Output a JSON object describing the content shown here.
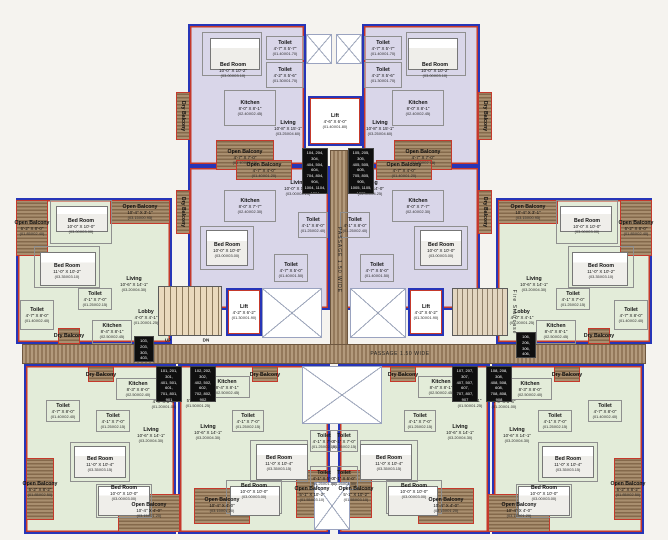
{
  "palette": {
    "unit_purple": "#d9d6e9",
    "unit_green": "#e3ecd9",
    "balcony_hatch": "#a98f6f",
    "passage_hatch": "#b39a7c",
    "wall_blue": "#2735b8",
    "wall_red": "#c5392b"
  },
  "passage": {
    "h": "PASSAGE 1.50 WIDE",
    "v": "PASSAGE 1.50 WIDE"
  },
  "stairs": {
    "up": "UP",
    "dn": "DN",
    "fire": "Fire Staircase"
  },
  "labels": [
    {
      "n": "Bed Room",
      "d": "10'-0\" X 10'-2\"",
      "m": "(03.00X03.10)",
      "x": 233,
      "y": 70
    },
    {
      "n": "Toilet",
      "d": "4'-7\" X 5'-7\"",
      "m": "(01.40X01.70)",
      "x": 285,
      "y": 48
    },
    {
      "n": "Toilet",
      "d": "4'-2\" X 5'-6\"",
      "m": "(01.30X01.70)",
      "x": 285,
      "y": 75
    },
    {
      "n": "Kitchen",
      "d": "8'-0\" X 8'-1\"",
      "m": "(02.40X02.45)",
      "x": 250,
      "y": 108
    },
    {
      "n": "Living",
      "d": "10'-8\" X 15'-1\"",
      "m": "(03.25X04.60)",
      "x": 288,
      "y": 128
    },
    {
      "n": "Open Balcony",
      "d": "4'-7\" X 7'-0\"",
      "m": "(01.40X02.15)",
      "x": 245,
      "y": 157
    },
    {
      "n": "Dry Balcony",
      "x": 183,
      "y": 116,
      "v": 1
    },
    {
      "n": "Bed Room",
      "d": "10'-0\" X 10'-2\"",
      "m": "(03.00X03.10)",
      "x": 435,
      "y": 70
    },
    {
      "n": "Toilet",
      "d": "4'-7\" X 5'-7\"",
      "m": "(01.40X01.70)",
      "x": 383,
      "y": 48
    },
    {
      "n": "Toilet",
      "d": "4'-2\" X 5'-6\"",
      "m": "(01.30X01.70)",
      "x": 383,
      "y": 75
    },
    {
      "n": "Kitchen",
      "d": "8'-0\" X 8'-1\"",
      "m": "(02.40X02.45)",
      "x": 418,
      "y": 108
    },
    {
      "n": "Living",
      "d": "10'-8\" X 15'-1\"",
      "m": "(03.25X04.60)",
      "x": 380,
      "y": 128
    },
    {
      "n": "Open Balcony",
      "d": "4'-7\" X 7'-0\"",
      "m": "(01.40X02.15)",
      "x": 423,
      "y": 157
    },
    {
      "n": "Dry Balcony",
      "x": 485,
      "y": 116,
      "v": 1
    },
    {
      "n": "Open Balcony",
      "d": "4'-7\" X 4'-0\"",
      "m": "(01.40X01.20)",
      "x": 264,
      "y": 170
    },
    {
      "n": "Living",
      "d": "10'-0\" X 14'-0\"",
      "m": "(03.00X04.25)",
      "x": 298,
      "y": 188
    },
    {
      "n": "Kitchen",
      "d": "8'-0\" X 7'-7\"",
      "m": "(02.40X02.30)",
      "x": 250,
      "y": 206
    },
    {
      "n": "Dry Balcony",
      "x": 183,
      "y": 212,
      "v": 1
    },
    {
      "n": "Bed Room",
      "d": "10'-0\" X 10'-0\"",
      "m": "(03.00X03.00)",
      "x": 227,
      "y": 250
    },
    {
      "n": "Toilet",
      "d": "4'-1\" X 8'-0\"",
      "m": "(01.25X02.40)",
      "x": 313,
      "y": 225
    },
    {
      "n": "Toilet",
      "d": "4'-7\" X 5'-0\"",
      "m": "(01.40X01.50)",
      "x": 291,
      "y": 270
    },
    {
      "n": "Open Balcony",
      "d": "4'-7\" X 4'-0\"",
      "m": "(01.40X01.20)",
      "x": 404,
      "y": 170
    },
    {
      "n": "Living",
      "d": "10'-0\" X 14'-0\"",
      "m": "(03.00X04.25)",
      "x": 370,
      "y": 188
    },
    {
      "n": "Kitchen",
      "d": "8'-0\" X 7'-7\"",
      "m": "(02.40X02.30)",
      "x": 418,
      "y": 206
    },
    {
      "n": "Dry Balcony",
      "x": 485,
      "y": 212,
      "v": 1
    },
    {
      "n": "Bed Room",
      "d": "10'-0\" X 10'-0\"",
      "m": "(03.00X03.00)",
      "x": 441,
      "y": 250
    },
    {
      "n": "Toilet",
      "d": "4'-1\" X 8'-0\"",
      "m": "(01.25X02.40)",
      "x": 355,
      "y": 225
    },
    {
      "n": "Toilet",
      "d": "4'-7\" X 5'-0\"",
      "m": "(01.40X01.50)",
      "x": 377,
      "y": 270
    },
    {
      "n": "Open Balcony",
      "d": "6'-2\" X 8'-0\"",
      "m": "(01.85X02.40)",
      "x": 32,
      "y": 228
    },
    {
      "n": "Bed Room",
      "d": "10'-0\" X 10'-0\"",
      "m": "(03.00X03.00)",
      "x": 81,
      "y": 226
    },
    {
      "n": "Bed Room",
      "d": "11'-0\" X 10'-2\"",
      "m": "(03.35X03.10)",
      "x": 67,
      "y": 271
    },
    {
      "n": "Open Balcony",
      "d": "10'-4\" X 3'-1\"",
      "m": "(03.15X00.95)",
      "x": 140,
      "y": 212
    },
    {
      "n": "Living",
      "d": "10'-6\" X 14'-1\"",
      "m": "(03.20X04.30)",
      "x": 134,
      "y": 284
    },
    {
      "n": "Toilet",
      "d": "4'-1\" X 7'-0\"",
      "m": "(01.25X02.15)",
      "x": 95,
      "y": 299
    },
    {
      "n": "Toilet",
      "d": "4'-7\" X 8'-0\"",
      "m": "(01.40X02.40)",
      "x": 37,
      "y": 315
    },
    {
      "n": "Lobby",
      "d": "4'-0\" X 4'-1\"",
      "m": "(01.20X01.25)",
      "x": 146,
      "y": 317
    },
    {
      "n": "Kitchen",
      "d": "8'-4\" X 8'-1\"",
      "m": "(02.50X02.45)",
      "x": 112,
      "y": 331
    },
    {
      "n": "Dry Balcony",
      "x": 69,
      "y": 336
    },
    {
      "n": "Open Balcony",
      "d": "6'-2\" X 8'-0\"",
      "m": "(01.85X02.40)",
      "x": 636,
      "y": 228
    },
    {
      "n": "Bed Room",
      "d": "10'-0\" X 10'-0\"",
      "m": "(03.00X03.00)",
      "x": 587,
      "y": 226
    },
    {
      "n": "Bed Room",
      "d": "11'-0\" X 10'-2\"",
      "m": "(03.35X03.10)",
      "x": 601,
      "y": 271
    },
    {
      "n": "Open Balcony",
      "d": "10'-4\" X 3'-1\"",
      "m": "(03.15X00.95)",
      "x": 528,
      "y": 212
    },
    {
      "n": "Living",
      "d": "10'-6\" X 14'-1\"",
      "m": "(03.20X04.30)",
      "x": 534,
      "y": 284
    },
    {
      "n": "Toilet",
      "d": "4'-1\" X 7'-0\"",
      "m": "(01.25X02.15)",
      "x": 573,
      "y": 299
    },
    {
      "n": "Toilet",
      "d": "4'-7\" X 8'-0\"",
      "m": "(01.40X02.40)",
      "x": 631,
      "y": 315
    },
    {
      "n": "Lobby",
      "d": "4'-0\" X 4'-1\"",
      "m": "(01.20X01.25)",
      "x": 522,
      "y": 317
    },
    {
      "n": "Kitchen",
      "d": "8'-4\" X 8'-1\"",
      "m": "(02.50X02.45)",
      "x": 556,
      "y": 331
    },
    {
      "n": "Dry Balcony",
      "x": 599,
      "y": 336
    },
    {
      "n": "Dry Balcony",
      "x": 101,
      "y": 375
    },
    {
      "n": "Kitchen",
      "d": "8'-3\" X 8'-0\"",
      "m": "(02.50X02.40)",
      "x": 138,
      "y": 389
    },
    {
      "n": "Lobby",
      "d": "4'-0\" X 3'-4\"",
      "m": "(01.20X01.00)",
      "x": 164,
      "y": 401
    },
    {
      "n": "Toilet",
      "d": "4'-7\" X 8'-0\"",
      "m": "(01.40X02.40)",
      "x": 63,
      "y": 411
    },
    {
      "n": "Toilet",
      "d": "4'-1\" X 7'-0\"",
      "m": "(01.25X02.15)",
      "x": 113,
      "y": 421
    },
    {
      "n": "Living",
      "d": "10'-6\" X 14'-1\"",
      "m": "(03.20X04.30)",
      "x": 151,
      "y": 435
    },
    {
      "n": "Bed Room",
      "d": "11'-0\" X 10'-4\"",
      "m": "(03.35X03.15)",
      "x": 100,
      "y": 464
    },
    {
      "n": "Bed Room",
      "d": "10'-0\" X 10'-0\"",
      "m": "(03.00X03.00)",
      "x": 124,
      "y": 493
    },
    {
      "n": "Open Balcony",
      "d": "6'-2\" X 8'-2\"",
      "m": "(01.85X02.50)",
      "x": 40,
      "y": 489
    },
    {
      "n": "Open Balcony",
      "d": "10'-4\" X 4'-0\"",
      "m": "(03.15X01.20)",
      "x": 149,
      "y": 510
    },
    {
      "n": "Dry Balcony",
      "x": 567,
      "y": 375
    },
    {
      "n": "Kitchen",
      "d": "8'-3\" X 8'-0\"",
      "m": "(02.50X02.40)",
      "x": 530,
      "y": 389
    },
    {
      "n": "Lobby",
      "d": "4'-0\" X 3'-4\"",
      "m": "(01.20X01.00)",
      "x": 504,
      "y": 401
    },
    {
      "n": "Toilet",
      "d": "4'-7\" X 8'-0\"",
      "m": "(01.40X02.40)",
      "x": 605,
      "y": 411
    },
    {
      "n": "Toilet",
      "d": "4'-1\" X 7'-0\"",
      "m": "(01.25X02.15)",
      "x": 555,
      "y": 421
    },
    {
      "n": "Living",
      "d": "10'-6\" X 14'-1\"",
      "m": "(03.20X04.30)",
      "x": 517,
      "y": 435
    },
    {
      "n": "Bed Room",
      "d": "11'-0\" X 10'-4\"",
      "m": "(03.35X03.15)",
      "x": 568,
      "y": 464
    },
    {
      "n": "Bed Room",
      "d": "10'-0\" X 10'-0\"",
      "m": "(03.00X03.00)",
      "x": 544,
      "y": 493
    },
    {
      "n": "Open Balcony",
      "d": "6'-2\" X 8'-2\"",
      "m": "(01.85X02.50)",
      "x": 628,
      "y": 489
    },
    {
      "n": "Open Balcony",
      "d": "10'-4\" X 4'-0\"",
      "m": "(03.15X01.20)",
      "x": 519,
      "y": 510
    },
    {
      "n": "Kitchen",
      "d": "8'-4\" X 8'-1\"",
      "m": "(02.50X02.45)",
      "x": 227,
      "y": 387
    },
    {
      "n": "Lobby",
      "d": "5'-0\" X 4'-1\"",
      "m": "(01.50X01.25)",
      "x": 198,
      "y": 400
    },
    {
      "n": "Dry Balcony",
      "x": 265,
      "y": 375
    },
    {
      "n": "Living",
      "d": "10'-6\" X 14'-1\"",
      "m": "(03.20X04.30)",
      "x": 208,
      "y": 432
    },
    {
      "n": "Toilet",
      "d": "4'-1\" X 7'-0\"",
      "m": "(01.25X02.15)",
      "x": 248,
      "y": 421
    },
    {
      "n": "Toilet",
      "d": "4'-1\" X 7'-0\"",
      "m": "(01.25X02.15)",
      "x": 324,
      "y": 441
    },
    {
      "n": "Toilet",
      "d": "4'-1\" X 5'-0\"",
      "m": "(01.25X01.50)",
      "x": 324,
      "y": 478
    },
    {
      "n": "Bed Room",
      "d": "11'-0\" X 10'-4\"",
      "m": "(03.35X03.15)",
      "x": 279,
      "y": 463
    },
    {
      "n": "Bed Room",
      "d": "10'-0\" X 10'-0\"",
      "m": "(03.00X03.00)",
      "x": 254,
      "y": 491
    },
    {
      "n": "Open Balcony",
      "d": "10'-4\" X 4'-0\"",
      "m": "(03.15X01.20)",
      "x": 222,
      "y": 505
    },
    {
      "n": "Open Balcony",
      "d": "5'-1\" X 10'-2\"",
      "m": "(01.55X03.10)",
      "x": 312,
      "y": 494
    },
    {
      "n": "Kitchen",
      "d": "8'-4\" X 8'-1\"",
      "m": "(02.50X02.45)",
      "x": 441,
      "y": 387
    },
    {
      "n": "Lobby",
      "d": "5'-0\" X 4'-1\"",
      "m": "(01.50X01.25)",
      "x": 470,
      "y": 400
    },
    {
      "n": "Dry Balcony",
      "x": 403,
      "y": 375
    },
    {
      "n": "Living",
      "d": "10'-6\" X 14'-1\"",
      "m": "(03.20X04.30)",
      "x": 460,
      "y": 432
    },
    {
      "n": "Toilet",
      "d": "4'-1\" X 7'-0\"",
      "m": "(01.25X02.15)",
      "x": 420,
      "y": 421
    },
    {
      "n": "Toilet",
      "d": "4'-1\" X 7'-0\"",
      "m": "(01.25X02.15)",
      "x": 344,
      "y": 441
    },
    {
      "n": "Toilet",
      "d": "4'-1\" X 5'-0\"",
      "m": "(01.25X01.50)",
      "x": 344,
      "y": 478
    },
    {
      "n": "Bed Room",
      "d": "11'-0\" X 10'-4\"",
      "m": "(03.35X03.15)",
      "x": 389,
      "y": 463
    },
    {
      "n": "Bed Room",
      "d": "10'-0\" X 10'-0\"",
      "m": "(03.00X03.00)",
      "x": 414,
      "y": 491
    },
    {
      "n": "Open Balcony",
      "d": "10'-4\" X 4'-0\"",
      "m": "(03.15X01.20)",
      "x": 446,
      "y": 505
    },
    {
      "n": "Open Balcony",
      "d": "5'-1\" X 10'-2\"",
      "m": "(01.55X03.10)",
      "x": 356,
      "y": 494
    },
    {
      "n": "Lift",
      "d": "4'-6\" X 6'-0\"",
      "m": "(01.40X01.80)",
      "x": 335,
      "y": 121
    },
    {
      "n": "Lift",
      "d": "4'-2\" X 6'-2\"",
      "m": "(01.30X01.90)",
      "x": 244,
      "y": 312
    },
    {
      "n": "Lift",
      "d": "4'-2\" X 6'-2\"",
      "m": "(01.30X01.90)",
      "x": 426,
      "y": 312
    }
  ],
  "flat_boxes": [
    {
      "t": "104, 204, 304,\n404, 504, 604,\n704, 804, 904,\n1004, 1104, 1204",
      "x": 302,
      "y": 148,
      "w": 26,
      "h": 46
    },
    {
      "t": "105, 205, 305,\n405, 505, 605,\n705, 805, 905,\n1005, 1105, 1205",
      "x": 348,
      "y": 148,
      "w": 26,
      "h": 46
    },
    {
      "t": "103, 203, 303,\n403, 503, 603,\n703, 803, 903",
      "x": 134,
      "y": 336,
      "w": 20,
      "h": 26
    },
    {
      "t": "106, 206, 306,\n406, 506, 606,\n706, 806, 906",
      "x": 516,
      "y": 332,
      "w": 20,
      "h": 26
    },
    {
      "t": "101, 201, 301,\n401, 501, 601,\n701, 801, 901",
      "x": 156,
      "y": 366,
      "w": 26,
      "h": 36
    },
    {
      "t": "102, 202, 302,\n402, 502, 602,\n702, 802, 902",
      "x": 190,
      "y": 366,
      "w": 26,
      "h": 36
    },
    {
      "t": "107, 207, 307,\n407, 507, 607,\n707, 807, 907",
      "x": 452,
      "y": 366,
      "w": 26,
      "h": 36
    },
    {
      "t": "108, 208, 308,\n408, 508, 608,\n708, 808, 908",
      "x": 486,
      "y": 366,
      "w": 26,
      "h": 36
    }
  ],
  "hatches": [
    [
      216,
      140,
      58,
      30
    ],
    [
      176,
      92,
      14,
      48
    ],
    [
      394,
      140,
      58,
      30
    ],
    [
      478,
      92,
      14,
      48
    ],
    [
      236,
      160,
      56,
      20
    ],
    [
      176,
      190,
      14,
      44
    ],
    [
      376,
      160,
      56,
      20
    ],
    [
      478,
      190,
      14,
      44
    ],
    [
      16,
      200,
      32,
      56
    ],
    [
      110,
      200,
      60,
      24
    ],
    [
      58,
      328,
      22,
      16
    ],
    [
      620,
      200,
      32,
      56
    ],
    [
      498,
      200,
      60,
      24
    ],
    [
      588,
      328,
      22,
      16
    ],
    [
      26,
      458,
      28,
      62
    ],
    [
      118,
      494,
      62,
      38
    ],
    [
      88,
      366,
      26,
      16
    ],
    [
      614,
      458,
      28,
      62
    ],
    [
      488,
      494,
      62,
      38
    ],
    [
      554,
      366,
      26,
      16
    ],
    [
      252,
      366,
      26,
      16
    ],
    [
      194,
      488,
      56,
      36
    ],
    [
      296,
      470,
      32,
      48
    ],
    [
      390,
      366,
      26,
      16
    ],
    [
      418,
      488,
      56,
      36
    ],
    [
      340,
      470,
      32,
      48
    ]
  ],
  "outlines": [
    [
      202,
      32,
      60,
      44
    ],
    [
      266,
      36,
      38,
      24
    ],
    [
      266,
      62,
      38,
      26
    ],
    [
      224,
      90,
      52,
      36
    ],
    [
      406,
      32,
      60,
      44
    ],
    [
      364,
      36,
      38,
      24
    ],
    [
      364,
      62,
      38,
      26
    ],
    [
      392,
      90,
      52,
      36
    ],
    [
      224,
      190,
      52,
      32
    ],
    [
      200,
      226,
      54,
      44
    ],
    [
      298,
      212,
      30,
      26
    ],
    [
      274,
      254,
      34,
      28
    ],
    [
      392,
      190,
      52,
      32
    ],
    [
      414,
      226,
      54,
      44
    ],
    [
      340,
      212,
      30,
      26
    ],
    [
      360,
      254,
      34,
      28
    ],
    [
      50,
      200,
      62,
      44
    ],
    [
      34,
      246,
      66,
      42
    ],
    [
      78,
      288,
      34,
      22
    ],
    [
      20,
      300,
      34,
      30
    ],
    [
      92,
      320,
      40,
      24
    ],
    [
      556,
      200,
      62,
      44
    ],
    [
      568,
      246,
      66,
      42
    ],
    [
      556,
      288,
      34,
      22
    ],
    [
      614,
      300,
      34,
      30
    ],
    [
      536,
      320,
      40,
      24
    ],
    [
      116,
      378,
      44,
      22
    ],
    [
      46,
      400,
      34,
      22
    ],
    [
      96,
      410,
      34,
      22
    ],
    [
      70,
      442,
      60,
      40
    ],
    [
      96,
      484,
      56,
      34
    ],
    [
      508,
      378,
      44,
      22
    ],
    [
      588,
      400,
      34,
      22
    ],
    [
      538,
      410,
      34,
      22
    ],
    [
      538,
      442,
      60,
      40
    ],
    [
      516,
      484,
      56,
      34
    ],
    [
      204,
      376,
      46,
      22
    ],
    [
      232,
      410,
      32,
      22
    ],
    [
      250,
      440,
      58,
      42
    ],
    [
      226,
      480,
      56,
      34
    ],
    [
      310,
      430,
      28,
      22
    ],
    [
      310,
      466,
      28,
      24
    ],
    [
      418,
      376,
      46,
      22
    ],
    [
      404,
      410,
      32,
      22
    ],
    [
      360,
      440,
      58,
      42
    ],
    [
      386,
      480,
      56,
      34
    ],
    [
      330,
      430,
      28,
      22
    ],
    [
      330,
      466,
      28,
      24
    ]
  ],
  "beds": [
    [
      210,
      38,
      50,
      32
    ],
    [
      408,
      38,
      50,
      32
    ],
    [
      206,
      230,
      42,
      36
    ],
    [
      420,
      230,
      42,
      36
    ],
    [
      56,
      206,
      52,
      26
    ],
    [
      40,
      252,
      56,
      34
    ],
    [
      560,
      206,
      52,
      26
    ],
    [
      572,
      252,
      56,
      34
    ],
    [
      74,
      446,
      52,
      32
    ],
    [
      98,
      486,
      52,
      30
    ],
    [
      542,
      446,
      52,
      32
    ],
    [
      518,
      486,
      52,
      30
    ],
    [
      256,
      444,
      52,
      36
    ],
    [
      230,
      486,
      50,
      30
    ],
    [
      360,
      444,
      52,
      36
    ],
    [
      388,
      486,
      50,
      30
    ]
  ],
  "xareas": [
    [
      306,
      34,
      26,
      30
    ],
    [
      336,
      34,
      26,
      30
    ],
    [
      262,
      288,
      60,
      50
    ],
    [
      350,
      288,
      56,
      50
    ],
    [
      302,
      366,
      80,
      58
    ],
    [
      314,
      482,
      36,
      48
    ]
  ]
}
